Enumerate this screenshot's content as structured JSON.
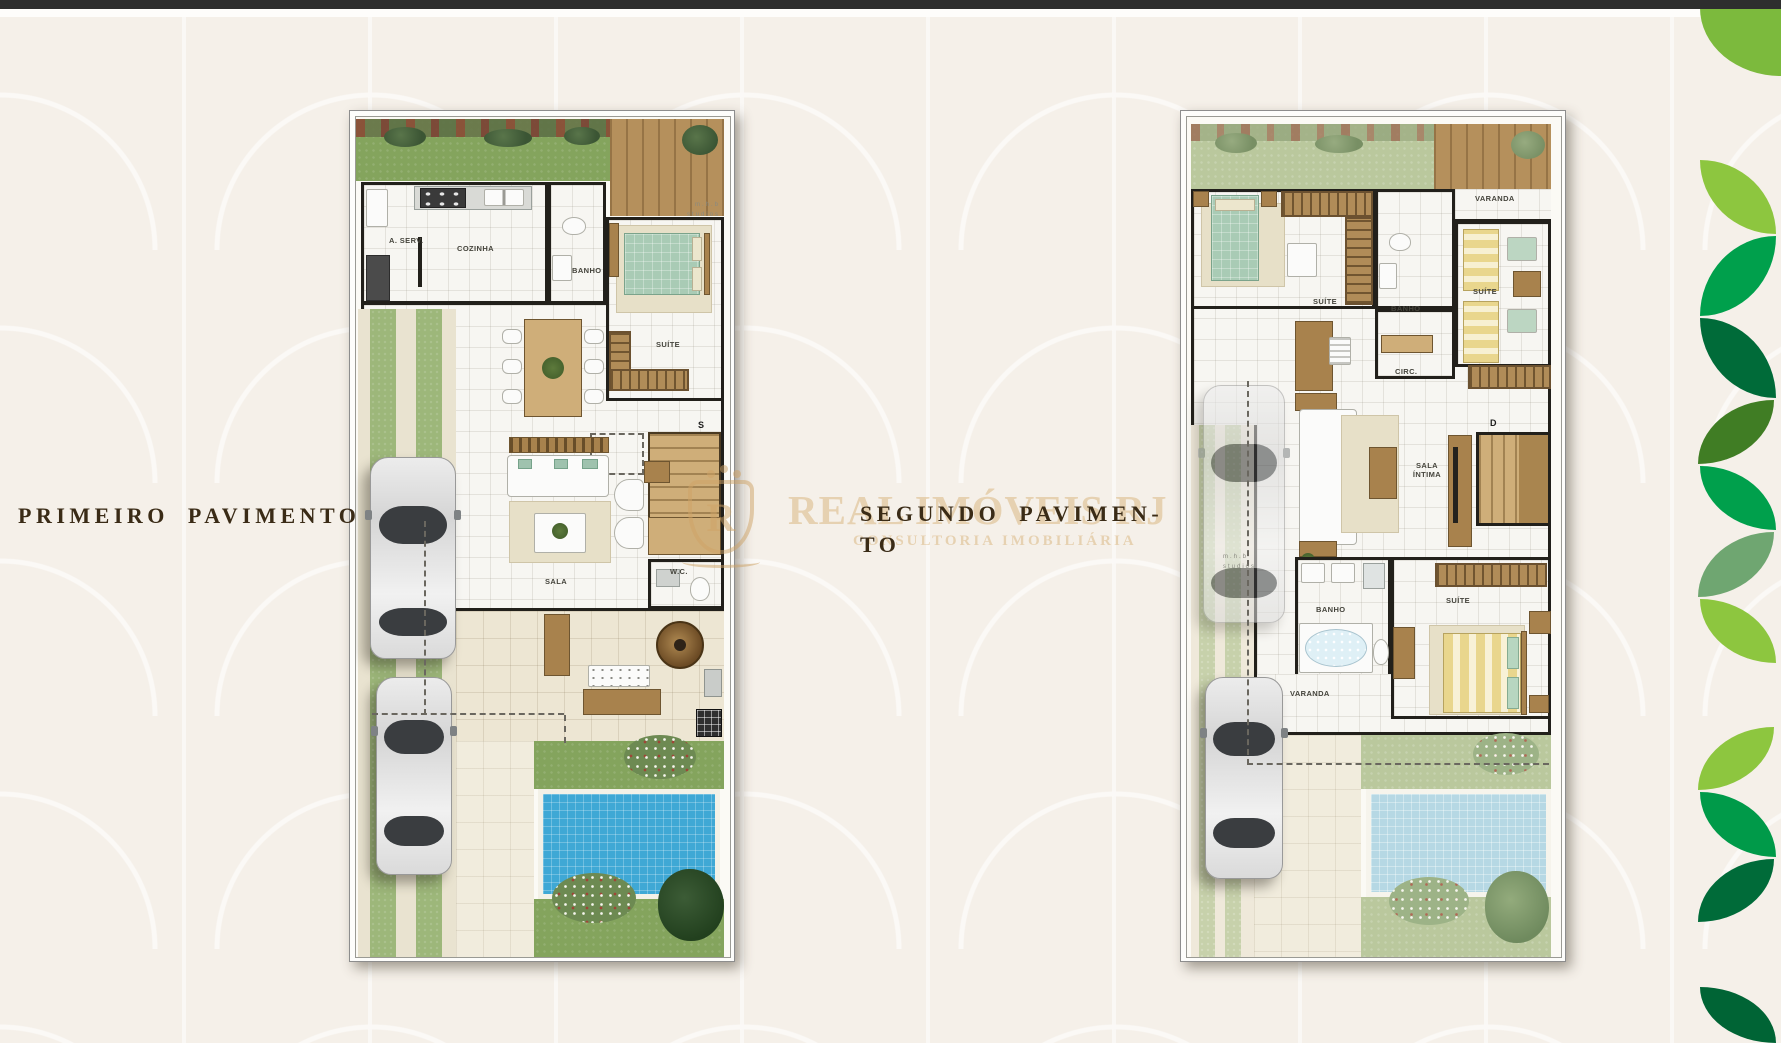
{
  "page": {
    "background": "#f5f0e9",
    "top_bar_color": "#2e2e2e"
  },
  "titles": {
    "first_floor": "PRIMEIRO PAVIMENTO",
    "second_floor_line1": "SEGUNDO PAVIMEN-",
    "second_floor_line2": "TO"
  },
  "watermark": {
    "logo_letter": "R",
    "brand": "REAL IMÓVEIS RJ",
    "tagline": "CONSULTORIA IMOBILIÁRIA",
    "color": "#d9b47b"
  },
  "first_plan": {
    "credit": {
      "line1": "m.h.b",
      "line2": "studios"
    },
    "stair_marker": "S",
    "labels": {
      "a_serv": "A. SERV.",
      "cozinha": "COZINHA",
      "banho": "BANHO",
      "suite": "SUÍTE",
      "sala": "SALA",
      "wc": "W.C."
    }
  },
  "second_plan": {
    "credit": {
      "line1": "m.h.b",
      "line2": "studios"
    },
    "stair_marker": "D",
    "labels": {
      "suite_top": "SUÍTE",
      "banho_top": "BANHO",
      "varanda_top": "VARANDA",
      "suite_right": "SUÍTE",
      "circ": "CIRC.",
      "sala_intima": "SALA ÍNTIMA",
      "banho_bottom": "BANHO",
      "suite_bottom": "SUÍTE",
      "varanda_bottom": "VARANDA"
    }
  },
  "palette": {
    "leaf_lime": "#8dc63f",
    "leaf_green": "#00a04c",
    "leaf_dark": "#006b39",
    "leaf_forest": "#407d24",
    "leaf_sage": "#6fa671",
    "pool_blue": "#3fa8d5",
    "pool_pale": "#b6d8e4",
    "grass_green": "#84a45d",
    "wood_brown": "#b5905c",
    "title_brown": "#3a2b16"
  },
  "leaf_strip": [
    {
      "top": 8,
      "height": 68,
      "left": 1700,
      "width": 81,
      "color": "#7cba3d",
      "shape": "bl"
    },
    {
      "top": 160,
      "height": 74,
      "left": 1700,
      "width": 76,
      "color": "#8dc63f",
      "shape": "tr-bl"
    },
    {
      "top": 236,
      "height": 80,
      "left": 1700,
      "width": 76,
      "color": "#00a04c",
      "shape": "tl-br"
    },
    {
      "top": 318,
      "height": 80,
      "left": 1700,
      "width": 76,
      "color": "#006b39",
      "shape": "tr-bl"
    },
    {
      "top": 400,
      "height": 64,
      "left": 1698,
      "width": 76,
      "color": "#407d24",
      "shape": "tl-br"
    },
    {
      "top": 466,
      "height": 64,
      "left": 1700,
      "width": 76,
      "color": "#00a04c",
      "shape": "tr-bl"
    },
    {
      "top": 532,
      "height": 65,
      "left": 1698,
      "width": 76,
      "color": "#6fa671",
      "shape": "tl-br"
    },
    {
      "top": 599,
      "height": 64,
      "left": 1700,
      "width": 76,
      "color": "#8dc63f",
      "shape": "tr-bl"
    },
    {
      "top": 727,
      "height": 63,
      "left": 1698,
      "width": 76,
      "color": "#8dc63f",
      "shape": "tl-br"
    },
    {
      "top": 792,
      "height": 65,
      "left": 1700,
      "width": 76,
      "color": "#009a49",
      "shape": "tr-bl"
    },
    {
      "top": 859,
      "height": 63,
      "left": 1698,
      "width": 76,
      "color": "#006b39",
      "shape": "tl-br"
    },
    {
      "top": 987,
      "height": 56,
      "left": 1700,
      "width": 76,
      "color": "#006435",
      "shape": "tr-bl"
    }
  ]
}
